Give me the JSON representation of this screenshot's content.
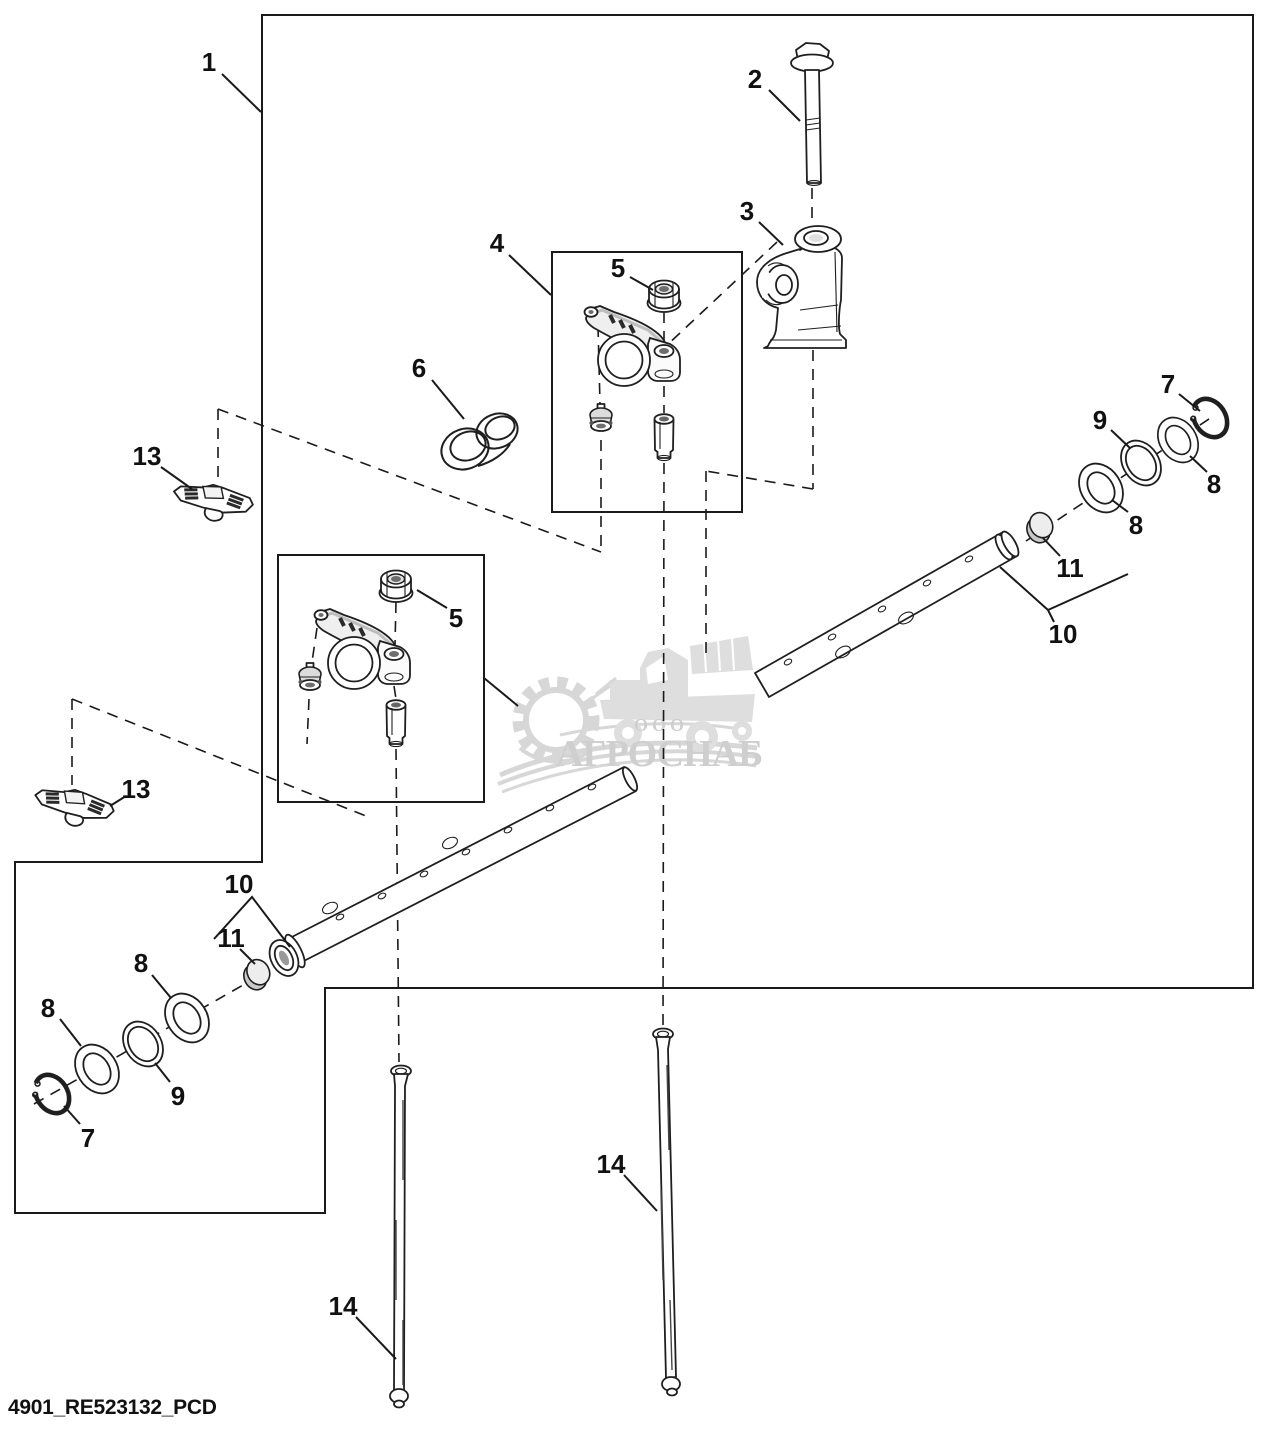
{
  "figure": {
    "footer_code": "4901_RE523132_PCD"
  },
  "watermark": {
    "org_form": "ООО",
    "name": "АГРОСНАБ",
    "color": "#cfcfcf"
  },
  "colors": {
    "line": "#1a1a1a",
    "background": "#ffffff",
    "part_fill": "#ffffff",
    "shading": "#e6e6e6"
  },
  "callouts": [
    {
      "id": "c0",
      "text": "1"
    },
    {
      "id": "c1",
      "text": "2"
    },
    {
      "id": "c2",
      "text": "3"
    },
    {
      "id": "c3",
      "text": "4"
    },
    {
      "id": "c4",
      "text": "5"
    },
    {
      "id": "c5",
      "text": "6"
    },
    {
      "id": "c6",
      "text": "13"
    },
    {
      "id": "c7",
      "text": "7"
    },
    {
      "id": "c8",
      "text": "9"
    },
    {
      "id": "c9",
      "text": "8"
    },
    {
      "id": "c10",
      "text": "8"
    },
    {
      "id": "c11",
      "text": "11"
    },
    {
      "id": "c12",
      "text": "10"
    },
    {
      "id": "c13",
      "text": "5"
    },
    {
      "id": "c14",
      "text": "13"
    },
    {
      "id": "c15",
      "text": "10"
    },
    {
      "id": "c16",
      "text": "11"
    },
    {
      "id": "c17",
      "text": "8"
    },
    {
      "id": "c18",
      "text": "8"
    },
    {
      "id": "c19",
      "text": "9"
    },
    {
      "id": "c20",
      "text": "7"
    },
    {
      "id": "c21",
      "text": "14"
    },
    {
      "id": "c22",
      "text": "14"
    }
  ]
}
